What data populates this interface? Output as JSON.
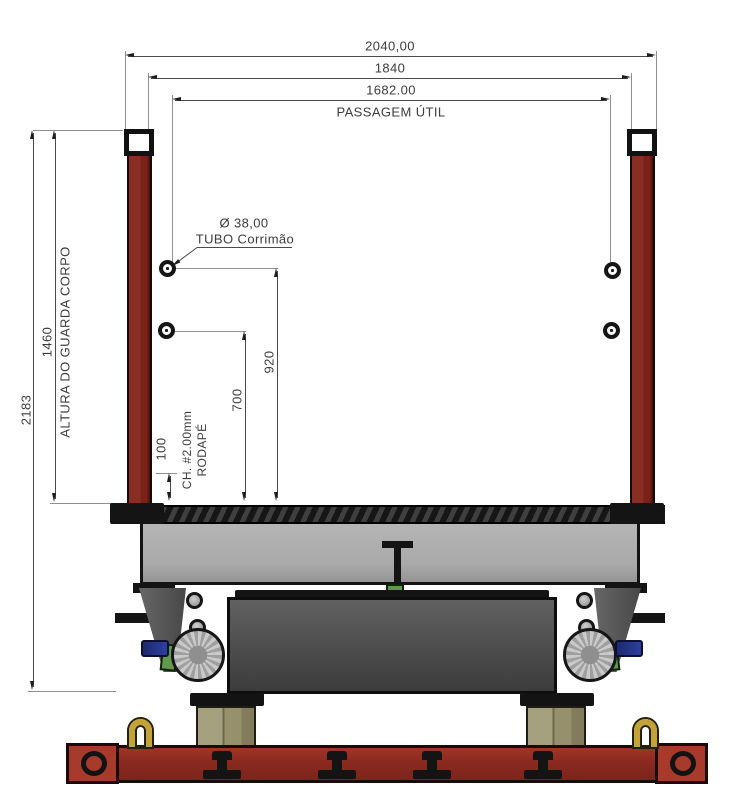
{
  "drawing": {
    "type": "technical-front-view",
    "labels": {
      "dim_overall_width": "2040,00",
      "dim_frame_width": "1840",
      "dim_passage_width": "1682.00",
      "passage_caption": "PASSAGEM ÚTIL",
      "dim_total_height": "2183",
      "dim_guard_height": "1460",
      "guard_caption": "ALTURA DO GUARDA CORPO",
      "dim_handrail_upper": "920",
      "dim_handrail_lower": "700",
      "dim_toeboard": "100",
      "toeboard_caption_line1": "CH. #2.00mm",
      "toeboard_caption_line2": "RODAPÉ",
      "handrail_tube_dia": "Ø 38,00",
      "handrail_tube_caption": "TUBO Corrimão"
    },
    "colors": {
      "post_red": "#7a2118",
      "base_red": "#8a2a20",
      "end_block_red": "#a83a2c",
      "beam_gray": "#a9a9a9",
      "box_gray": "#4b4b4b",
      "pedestal_khaki": "#96916c",
      "wheel_gray": "#bcbcbc",
      "accent_green": "#63994e",
      "accent_blue": "#2e3f9f",
      "shackle_gold": "#c3a238",
      "outline_black": "#141414",
      "dim_line": "#4a4a4a",
      "ext_line": "#8f8f8f",
      "text": "#3d3d3d"
    }
  }
}
